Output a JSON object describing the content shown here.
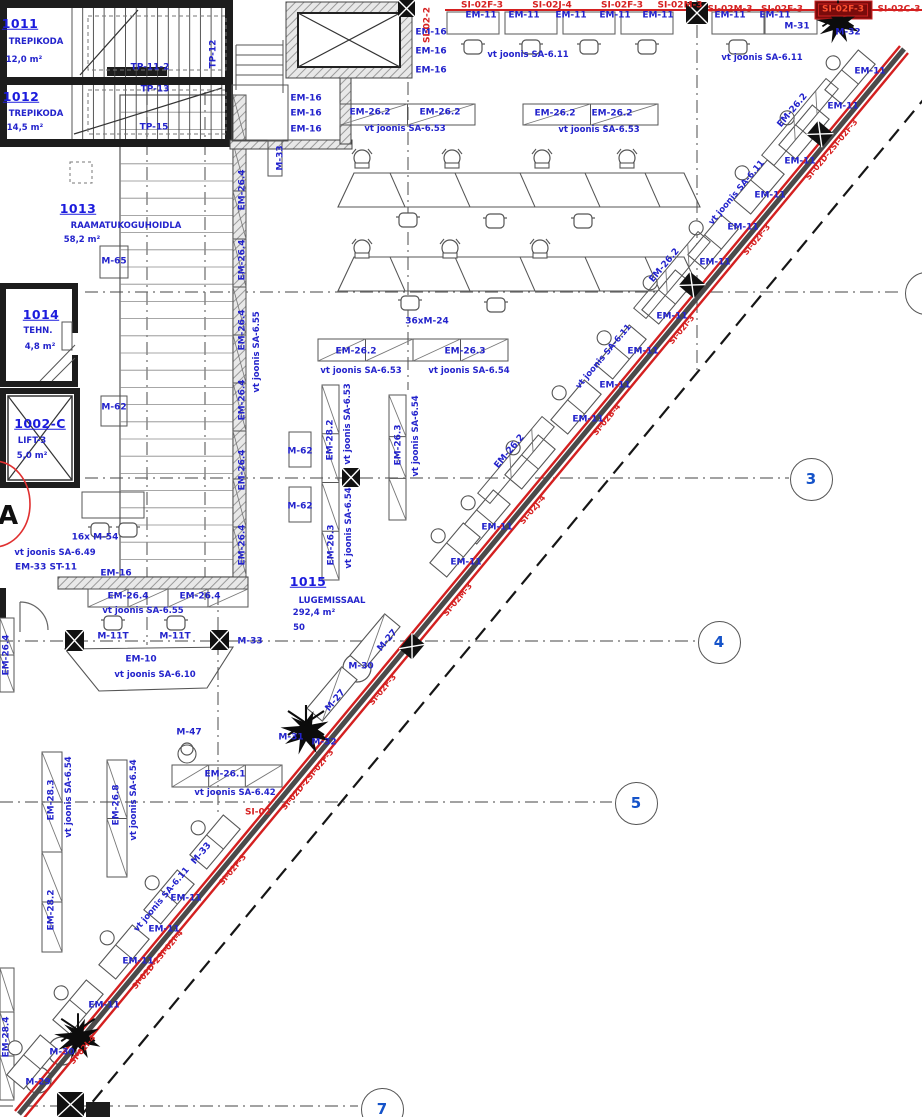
{
  "meta": {
    "drawing_type": "architectural floor plan (CAD)",
    "language": "Estonian",
    "colors": {
      "annotation_blue": "#2323cc",
      "annotation_red": "#d62020",
      "selected_red_bg": "#7a0b0b",
      "wall_black": "#1d1d1d",
      "grid_gray": "#666666"
    }
  },
  "rooms": [
    {
      "number": "1011",
      "name": "TREPIKODA",
      "area": "12,0 m²"
    },
    {
      "number": "1012",
      "name": "TREPIKODA",
      "area": "14,5 m²"
    },
    {
      "number": "1013",
      "name": "RAAMATUKOGUHOIDLA",
      "area": "58,2 m²"
    },
    {
      "number": "1014",
      "name": "TEHN.",
      "area": "4,8 m²"
    },
    {
      "number": "1002-C",
      "name": "LIFT-3",
      "area": "5,0 m²"
    },
    {
      "number": "1015",
      "name": "LUGEMISSAAL",
      "area": "292,4 m²",
      "capacity": "50"
    }
  ],
  "grid_bubbles": [
    {
      "label": "3",
      "x": 810,
      "y": 478
    },
    {
      "label": "4",
      "x": 718,
      "y": 641
    },
    {
      "label": "5",
      "x": 635,
      "y": 802
    },
    {
      "label": "7",
      "x": 381,
      "y": 1108
    },
    {
      "label": "",
      "x": 925,
      "y": 292
    }
  ],
  "labels": [
    {
      "t": "1011",
      "x": 20,
      "y": 24,
      "c": "num"
    },
    {
      "t": "TREPIKODA",
      "x": 36,
      "y": 42,
      "c": "name"
    },
    {
      "t": "12,0 m²",
      "x": 24,
      "y": 60,
      "c": "name"
    },
    {
      "t": "1012",
      "x": 21,
      "y": 97,
      "c": "num"
    },
    {
      "t": "TREPIKODA",
      "x": 36,
      "y": 114,
      "c": "name"
    },
    {
      "t": "14,5 m²",
      "x": 25,
      "y": 128,
      "c": "name"
    },
    {
      "t": "TP-11-2",
      "x": 150,
      "y": 68
    },
    {
      "t": "TP-13",
      "x": 155,
      "y": 90
    },
    {
      "t": "TP-15",
      "x": 154,
      "y": 128
    },
    {
      "t": "TP-12",
      "x": 214,
      "y": 54,
      "r": -90
    },
    {
      "t": "1013",
      "x": 78,
      "y": 209,
      "c": "num"
    },
    {
      "t": "RAAMATUKOGUHOIDLA",
      "x": 126,
      "y": 226,
      "c": "name"
    },
    {
      "t": "58,2 m²",
      "x": 82,
      "y": 240,
      "c": "name"
    },
    {
      "t": "1014",
      "x": 41,
      "y": 315,
      "c": "num"
    },
    {
      "t": "TEHN.",
      "x": 38,
      "y": 331,
      "c": "name"
    },
    {
      "t": "4,8 m²",
      "x": 40,
      "y": 347,
      "c": "name"
    },
    {
      "t": "1002-C",
      "x": 40,
      "y": 424,
      "c": "num"
    },
    {
      "t": "LIFT-3",
      "x": 32,
      "y": 441,
      "c": "name"
    },
    {
      "t": "5,0 m²",
      "x": 32,
      "y": 456,
      "c": "name"
    },
    {
      "t": "A",
      "x": 8,
      "y": 516,
      "c": "big"
    },
    {
      "t": "1015",
      "x": 308,
      "y": 582,
      "c": "num"
    },
    {
      "t": "LUGEMISSAAL",
      "x": 332,
      "y": 601,
      "c": "name"
    },
    {
      "t": "292,4 m²",
      "x": 314,
      "y": 613,
      "c": "name"
    },
    {
      "t": "50",
      "x": 299,
      "y": 628,
      "c": "name"
    },
    {
      "t": "EM-16",
      "x": 431,
      "y": 33
    },
    {
      "t": "EM-16",
      "x": 431,
      "y": 52
    },
    {
      "t": "EM-16",
      "x": 431,
      "y": 71
    },
    {
      "t": "EM-16",
      "x": 306,
      "y": 99
    },
    {
      "t": "EM-16",
      "x": 306,
      "y": 114
    },
    {
      "t": "EM-16",
      "x": 306,
      "y": 130
    },
    {
      "t": "EM-16",
      "x": 116,
      "y": 574
    },
    {
      "t": "16x M-54",
      "x": 95,
      "y": 538
    },
    {
      "t": "vt joonis SA-6.49",
      "x": 55,
      "y": 553,
      "c": "vt"
    },
    {
      "t": "EM-33 ST-11",
      "x": 46,
      "y": 568
    },
    {
      "t": "M-65",
      "x": 114,
      "y": 262
    },
    {
      "t": "M-62",
      "x": 114,
      "y": 408
    },
    {
      "t": "M-62",
      "x": 300,
      "y": 452
    },
    {
      "t": "M-62",
      "x": 300,
      "y": 507
    },
    {
      "t": "M-33",
      "x": 281,
      "y": 158,
      "r": -90
    },
    {
      "t": "M-33",
      "x": 250,
      "y": 642
    },
    {
      "t": "M-33",
      "x": 202,
      "y": 854,
      "r": -50
    },
    {
      "t": "M-11T",
      "x": 113,
      "y": 637
    },
    {
      "t": "M-11T",
      "x": 175,
      "y": 637
    },
    {
      "t": "M-47",
      "x": 189,
      "y": 733
    },
    {
      "t": "M-27",
      "x": 388,
      "y": 641,
      "r": -50
    },
    {
      "t": "M-27",
      "x": 336,
      "y": 701,
      "r": -50
    },
    {
      "t": "M-30",
      "x": 361,
      "y": 667
    },
    {
      "t": "M-31",
      "x": 291,
      "y": 738
    },
    {
      "t": "M-32",
      "x": 324,
      "y": 743
    },
    {
      "t": "M-31",
      "x": 797,
      "y": 27
    },
    {
      "t": "M-32",
      "x": 848,
      "y": 33
    },
    {
      "t": "M-30",
      "x": 62,
      "y": 1053
    },
    {
      "t": "M-29",
      "x": 38,
      "y": 1083
    },
    {
      "t": "36xM-24",
      "x": 427,
      "y": 322
    },
    {
      "t": "EM-10",
      "x": 141,
      "y": 660
    },
    {
      "t": "vt joonis SA-6.10",
      "x": 155,
      "y": 675,
      "c": "vt"
    },
    {
      "t": "EM-26.2",
      "x": 370,
      "y": 113
    },
    {
      "t": "EM-26.2",
      "x": 440,
      "y": 113
    },
    {
      "t": "vt joonis SA-6.53",
      "x": 405,
      "y": 129,
      "c": "vt"
    },
    {
      "t": "EM-26.2",
      "x": 555,
      "y": 114
    },
    {
      "t": "EM-26.2",
      "x": 612,
      "y": 114
    },
    {
      "t": "vt joonis SA-6.53",
      "x": 599,
      "y": 130,
      "c": "vt"
    },
    {
      "t": "EM-26.2",
      "x": 356,
      "y": 352
    },
    {
      "t": "EM-26.3",
      "x": 465,
      "y": 352
    },
    {
      "t": "vt joonis SA-6.53",
      "x": 361,
      "y": 371,
      "c": "vt"
    },
    {
      "t": "vt joonis SA-6.54",
      "x": 469,
      "y": 371,
      "c": "vt"
    },
    {
      "t": "EM-26.1",
      "x": 225,
      "y": 775
    },
    {
      "t": "vt joonis SA-6.42",
      "x": 235,
      "y": 793,
      "c": "vt"
    },
    {
      "t": "vt joonis SA-6.55",
      "x": 143,
      "y": 611,
      "c": "vt"
    },
    {
      "t": "EM-26.4",
      "x": 128,
      "y": 597
    },
    {
      "t": "EM-26.4",
      "x": 200,
      "y": 597
    },
    {
      "t": "EM-26.4",
      "x": 243,
      "y": 190,
      "r": -90
    },
    {
      "t": "EM-26.4",
      "x": 243,
      "y": 260,
      "r": -90
    },
    {
      "t": "EM-26.4",
      "x": 243,
      "y": 330,
      "r": -90
    },
    {
      "t": "EM-26.4",
      "x": 243,
      "y": 400,
      "r": -90
    },
    {
      "t": "EM-26.4",
      "x": 243,
      "y": 470,
      "r": -90
    },
    {
      "t": "EM-26.4",
      "x": 243,
      "y": 545,
      "r": -90
    },
    {
      "t": "vt joonis SA-6.55",
      "x": 257,
      "y": 352,
      "r": -90,
      "c": "vt"
    },
    {
      "t": "EM-28.2",
      "x": 331,
      "y": 440,
      "r": -90
    },
    {
      "t": "vt joonis SA-6.53",
      "x": 348,
      "y": 424,
      "r": -90,
      "c": "vt"
    },
    {
      "t": "EM-26.3",
      "x": 332,
      "y": 545,
      "r": -90
    },
    {
      "t": "vt joonis SA-6.54",
      "x": 349,
      "y": 528,
      "r": -90,
      "c": "vt"
    },
    {
      "t": "EM-26.3",
      "x": 399,
      "y": 445,
      "r": -90
    },
    {
      "t": "vt joonis SA-6.54",
      "x": 416,
      "y": 436,
      "r": -90,
      "c": "vt"
    },
    {
      "t": "EM-28.3",
      "x": 52,
      "y": 800,
      "r": -90
    },
    {
      "t": "vt joonis SA-6.54",
      "x": 69,
      "y": 797,
      "r": -90,
      "c": "vt"
    },
    {
      "t": "EM-26.8",
      "x": 117,
      "y": 805,
      "r": -90
    },
    {
      "t": "vt joonis SA-6.54",
      "x": 134,
      "y": 800,
      "r": -90,
      "c": "vt"
    },
    {
      "t": "EM-28.2",
      "x": 52,
      "y": 910,
      "r": -90
    },
    {
      "t": "EM-26.4",
      "x": 7,
      "y": 655,
      "r": -90
    },
    {
      "t": "EM-28.4",
      "x": 7,
      "y": 1037,
      "r": -90
    },
    {
      "t": "EM-11",
      "x": 481,
      "y": 16
    },
    {
      "t": "EM-11",
      "x": 524,
      "y": 16
    },
    {
      "t": "EM-11",
      "x": 571,
      "y": 16
    },
    {
      "t": "EM-11",
      "x": 615,
      "y": 16
    },
    {
      "t": "EM-11",
      "x": 658,
      "y": 16
    },
    {
      "t": "EM-11",
      "x": 730,
      "y": 16
    },
    {
      "t": "EM-11",
      "x": 775,
      "y": 16
    },
    {
      "t": "vt joonis SA-6.11",
      "x": 528,
      "y": 55,
      "c": "vt"
    },
    {
      "t": "vt joonis SA-6.11",
      "x": 762,
      "y": 58,
      "c": "vt"
    },
    {
      "t": "SI-02F-3",
      "x": 482,
      "y": 6,
      "c": "red"
    },
    {
      "t": "SI-02J-4",
      "x": 552,
      "y": 6,
      "c": "red"
    },
    {
      "t": "SI-02F-3",
      "x": 622,
      "y": 6,
      "c": "red"
    },
    {
      "t": "SI-02M-3",
      "x": 680,
      "y": 6,
      "c": "red"
    },
    {
      "t": "SI-02M-3",
      "x": 730,
      "y": 10,
      "c": "red"
    },
    {
      "t": "SI-02F-3",
      "x": 782,
      "y": 10,
      "c": "red"
    },
    {
      "t": "SI-02F-3",
      "x": 843,
      "y": 10,
      "c": "redbox"
    },
    {
      "t": "SI-02C-3",
      "x": 899,
      "y": 10,
      "c": "red"
    },
    {
      "t": "SI-02-2",
      "x": 428,
      "y": 25,
      "r": -90,
      "c": "red"
    },
    {
      "t": "SI-02",
      "x": 258,
      "y": 813,
      "c": "red"
    },
    {
      "t": "SI-02D-2SI-02F-3",
      "x": 832,
      "y": 150,
      "r": -50,
      "c": "redw"
    },
    {
      "t": "SI-02F-3",
      "x": 757,
      "y": 240,
      "r": -50,
      "c": "redw"
    },
    {
      "t": "SI-02I-3",
      "x": 682,
      "y": 330,
      "r": -50,
      "c": "redw"
    },
    {
      "t": "SI-02B-4",
      "x": 607,
      "y": 420,
      "r": -50,
      "c": "redw"
    },
    {
      "t": "SI-02J-4",
      "x": 533,
      "y": 510,
      "r": -50,
      "c": "redw"
    },
    {
      "t": "SI-02M-3",
      "x": 458,
      "y": 600,
      "r": -50,
      "c": "redw"
    },
    {
      "t": "SI-02F-3",
      "x": 383,
      "y": 690,
      "r": -50,
      "c": "redw"
    },
    {
      "t": "SI-02D-2SI-02F-3",
      "x": 308,
      "y": 780,
      "r": -50,
      "c": "redw"
    },
    {
      "t": "SI-02F-3",
      "x": 233,
      "y": 870,
      "r": -50,
      "c": "redw"
    },
    {
      "t": "SI-02D-2SI-02I-4",
      "x": 158,
      "y": 960,
      "r": -50,
      "c": "redw"
    },
    {
      "t": "SI-02I-4",
      "x": 83,
      "y": 1050,
      "r": -50,
      "c": "redw"
    },
    {
      "t": "EM-26.2",
      "x": 793,
      "y": 111,
      "r": -50
    },
    {
      "t": "EM-26.2",
      "x": 665,
      "y": 266,
      "r": -50
    },
    {
      "t": "EM-26.2",
      "x": 510,
      "y": 452,
      "r": -50
    },
    {
      "t": "EM-11",
      "x": 870,
      "y": 72
    },
    {
      "t": "EM-11",
      "x": 843,
      "y": 107
    },
    {
      "t": "EM-11",
      "x": 800,
      "y": 162
    },
    {
      "t": "EM-11",
      "x": 770,
      "y": 196
    },
    {
      "t": "EM-11",
      "x": 743,
      "y": 228
    },
    {
      "t": "EM-11",
      "x": 715,
      "y": 263
    },
    {
      "t": "EM-11",
      "x": 672,
      "y": 317
    },
    {
      "t": "EM-11",
      "x": 643,
      "y": 352
    },
    {
      "t": "EM-11",
      "x": 615,
      "y": 386
    },
    {
      "t": "EM-11",
      "x": 588,
      "y": 420
    },
    {
      "t": "EM-11",
      "x": 497,
      "y": 528
    },
    {
      "t": "EM-11",
      "x": 466,
      "y": 563
    },
    {
      "t": "EM-11",
      "x": 186,
      "y": 899
    },
    {
      "t": "EM-11",
      "x": 164,
      "y": 930
    },
    {
      "t": "EM-11",
      "x": 138,
      "y": 962
    },
    {
      "t": "EM-11",
      "x": 104,
      "y": 1006
    },
    {
      "t": "vt joonis SA-6.11",
      "x": 737,
      "y": 193,
      "r": -50,
      "c": "vt"
    },
    {
      "t": "vt joonis SA-6.11",
      "x": 604,
      "y": 357,
      "r": -50,
      "c": "vt"
    },
    {
      "t": "vt joonis SA-6.11",
      "x": 162,
      "y": 900,
      "r": -50,
      "c": "vt"
    }
  ]
}
